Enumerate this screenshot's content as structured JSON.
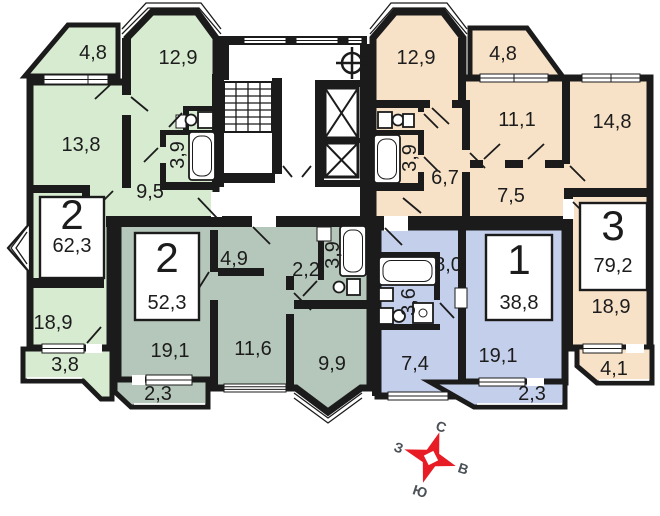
{
  "plan": {
    "background": "#ffffff",
    "wall_color": "#1b1b1b",
    "compass": {
      "north": "С",
      "east": "В",
      "south": "Ю",
      "west": "З",
      "star_color": "#e81c25",
      "letter_color": "#4b5157"
    },
    "apartments": [
      {
        "name": "left-two-room",
        "number": "2",
        "total_area": "62,3",
        "fill": "#d7ebd1",
        "rooms": [
          {
            "name": "balcony",
            "area": "4,8"
          },
          {
            "name": "room",
            "area": "12,9"
          },
          {
            "name": "room",
            "area": "13,8"
          },
          {
            "name": "hall",
            "area": "9,5"
          },
          {
            "name": "bathroom",
            "area": "3,9"
          },
          {
            "name": "room",
            "area": "18,9"
          },
          {
            "name": "balcony",
            "area": "3,8"
          }
        ]
      },
      {
        "name": "center-left-two-room",
        "number": "2",
        "total_area": "52,3",
        "fill": "#b5c6ba",
        "rooms": [
          {
            "name": "hall",
            "area": "4,9"
          },
          {
            "name": "hall",
            "area": "2,2"
          },
          {
            "name": "bathroom",
            "area": "3,9"
          },
          {
            "name": "room",
            "area": "11,6"
          },
          {
            "name": "room",
            "area": "9,9"
          },
          {
            "name": "room",
            "area": "19,1"
          },
          {
            "name": "balcony",
            "area": "2,3"
          }
        ]
      },
      {
        "name": "center-right-one-room",
        "number": "1",
        "total_area": "38,8",
        "fill": "#c4cfeb",
        "rooms": [
          {
            "name": "kitchen",
            "area": "8,0"
          },
          {
            "name": "bathroom",
            "area": "3,6"
          },
          {
            "name": "room",
            "area": "7,4"
          },
          {
            "name": "room",
            "area": "19,1"
          },
          {
            "name": "balcony",
            "area": "2,3"
          }
        ]
      },
      {
        "name": "right-three-room",
        "number": "3",
        "total_area": "79,2",
        "fill": "#f8e2c7",
        "rooms": [
          {
            "name": "room",
            "area": "12,9"
          },
          {
            "name": "balcony",
            "area": "4,8"
          },
          {
            "name": "room",
            "area": "11,1"
          },
          {
            "name": "room",
            "area": "14,8"
          },
          {
            "name": "kitchen",
            "area": "6,7"
          },
          {
            "name": "hall",
            "area": "7,5"
          },
          {
            "name": "bathroom",
            "area": "3,9"
          },
          {
            "name": "room",
            "area": "18,9"
          },
          {
            "name": "balcony",
            "area": "4,1"
          }
        ]
      }
    ]
  }
}
